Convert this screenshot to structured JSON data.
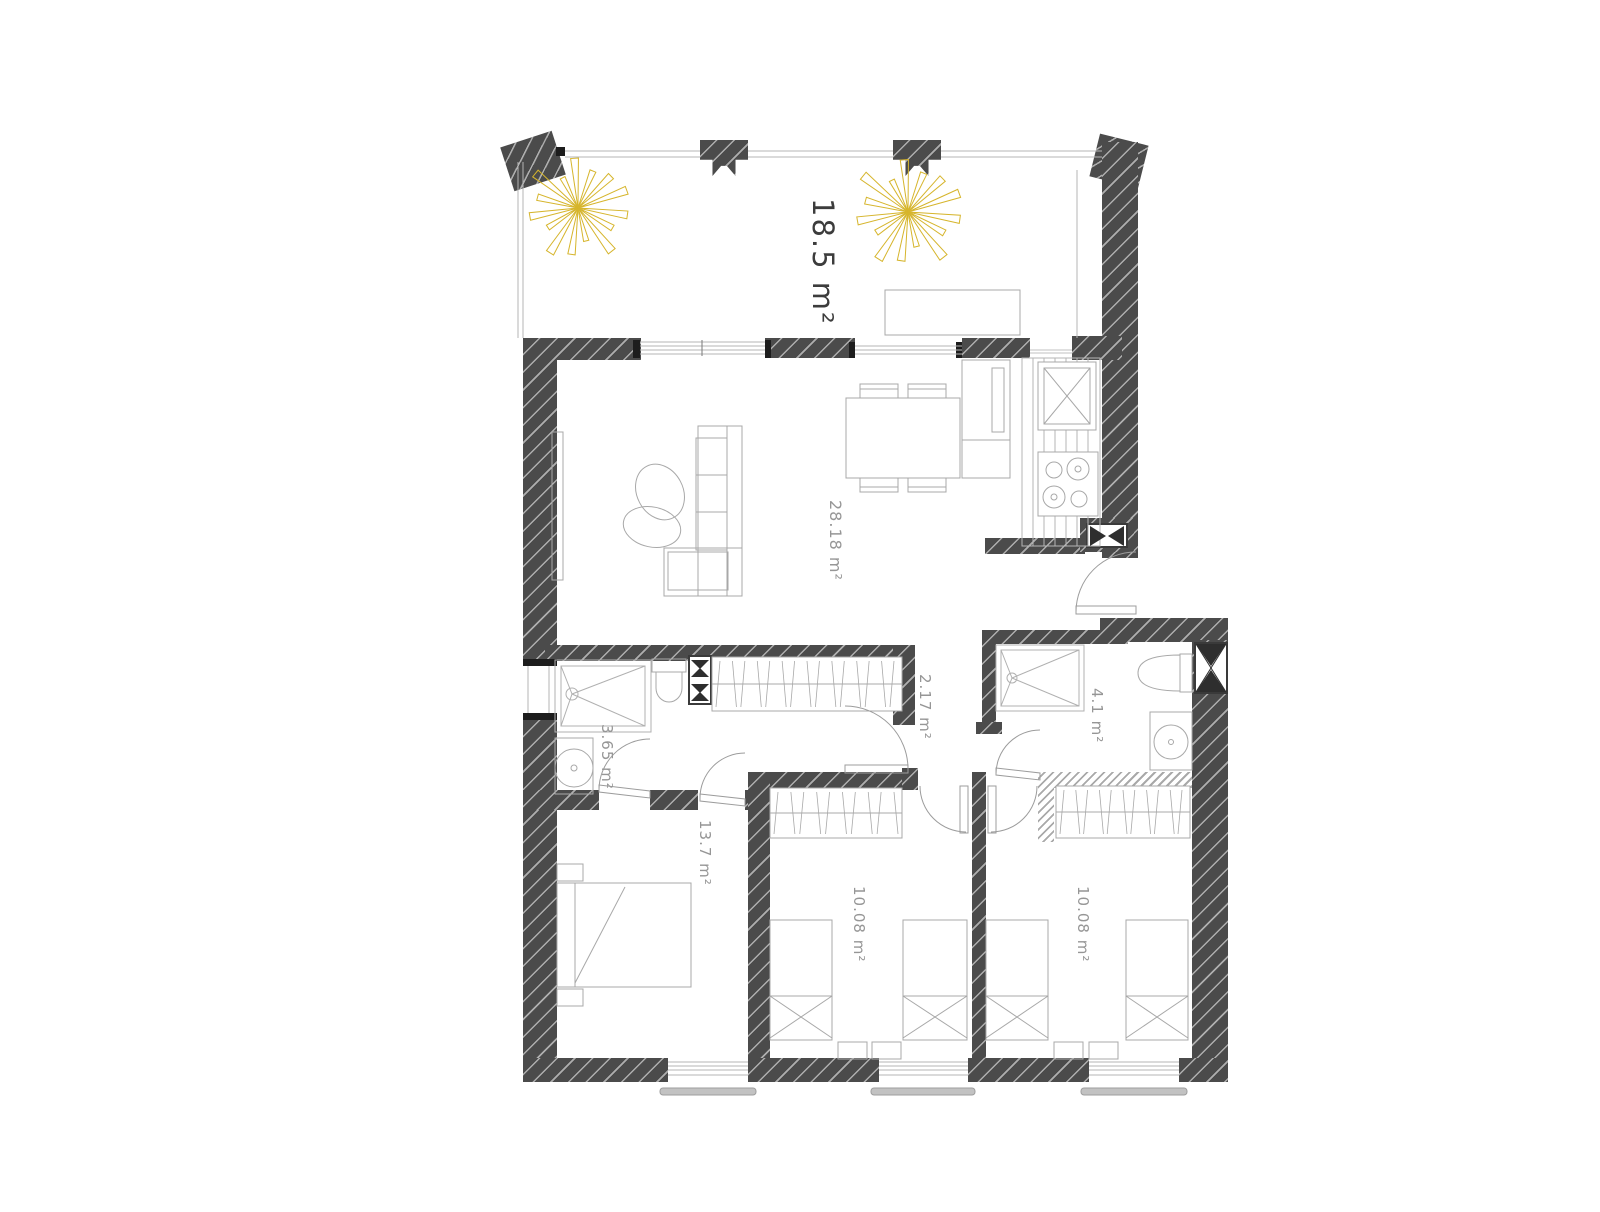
{
  "plan": {
    "type": "apartment-floor-plan",
    "colors": {
      "wall": "#4b4b4b",
      "furniture_line": "#a8a8a8",
      "door_line": "#9c9c9c",
      "label": "#969696",
      "terrace_label": "#3c3c3c",
      "plant_yellow": "#d6b52c",
      "sill": "#c2c2c2"
    },
    "rooms": [
      {
        "id": "terrace",
        "area_label": "18.5 m²"
      },
      {
        "id": "living-kitchen",
        "area_label": "28.18 m²"
      },
      {
        "id": "hallway",
        "area_label": "2.17 m²"
      },
      {
        "id": "bathroom-right",
        "area_label": "4.1 m²"
      },
      {
        "id": "bathroom-left",
        "area_label": "3.65 m²"
      },
      {
        "id": "bedroom-main",
        "area_label": "13.7 m²"
      },
      {
        "id": "bedroom-middle",
        "area_label": "10.08 m²"
      },
      {
        "id": "bedroom-right",
        "area_label": "10.08 m²"
      }
    ],
    "fixtures": [
      "plant",
      "sofa",
      "pouf",
      "tv-board",
      "dining-table",
      "chair",
      "fridge",
      "kitchen-sink",
      "cooktop",
      "counter",
      "wardrobe",
      "shower",
      "toilet",
      "washing-machine",
      "vanity-sink",
      "double-bed",
      "single-bed",
      "nightstand",
      "door",
      "window",
      "column"
    ]
  }
}
